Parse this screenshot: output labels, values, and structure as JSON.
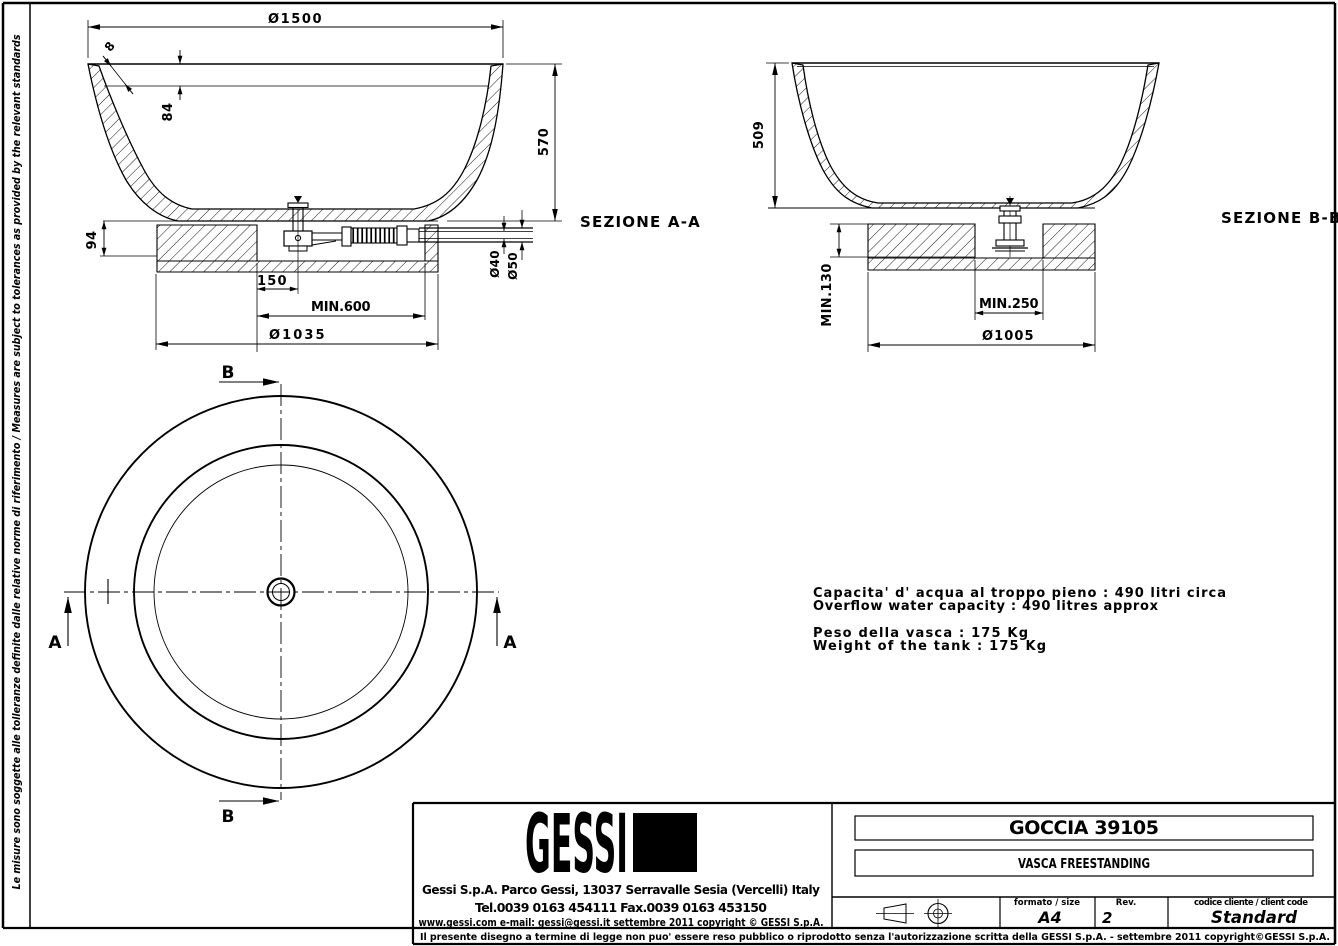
{
  "colors": {
    "ink": "#000000",
    "paper": "#ffffff"
  },
  "frame": {
    "side_note": "Le misure sono soggette alle tolleranze definite dalle relative norme di riferimento / Measures are subject to tolerances as provided by the relevant standards",
    "disclaimer": "Il presente disegno a termine di legge non puo' essere reso pubblico o riprodotto senza l'autorizzazione scritta della GESSI S.p.A. - settembre 2011 copyright©GESSI S.p.A."
  },
  "section_a": {
    "label": "SEZIONE A-A",
    "dia_top": "Ø1500",
    "wall_thickness": "8",
    "rim_drop": "84",
    "height": "570",
    "base_height": "94",
    "drain_offset": "150",
    "clearance": "MIN.600",
    "base_dia": "Ø1035",
    "pipe_inner": "Ø40",
    "pipe_outer": "Ø50"
  },
  "section_b": {
    "label": "SEZIONE B-B",
    "height": "509",
    "base_depth": "MIN.130",
    "clearance": "MIN.250",
    "base_dia": "Ø1005"
  },
  "plan": {
    "cut_a": "A",
    "cut_b": "B"
  },
  "notes": {
    "capacity_it": "Capacita' d' acqua al troppo pieno : 490 litri circa",
    "capacity_en": "Overflow water capacity : 490 litres approx",
    "weight_it": "Peso della vasca : 175 Kg",
    "weight_en": "Weight of the tank : 175 Kg"
  },
  "title_block": {
    "logo": "GESSI",
    "address": "Gessi S.p.A. Parco Gessi, 13037 Serravalle Sesia (Vercelli) Italy",
    "phone": "Tel.0039 0163 454111 Fax.0039 0163 453150",
    "web": "www.gessi.com e-mail: gessi@gessi.it settembre 2011 copyright © GESSI S.p.A.",
    "product": "GOCCIA 39105",
    "type": "VASCA FREESTANDING",
    "format_label": "formato / size",
    "format_value": "A4",
    "rev_label": "Rev.",
    "rev_value": "2",
    "client_label": "codice cliente / client code",
    "client_value": "Standard"
  }
}
